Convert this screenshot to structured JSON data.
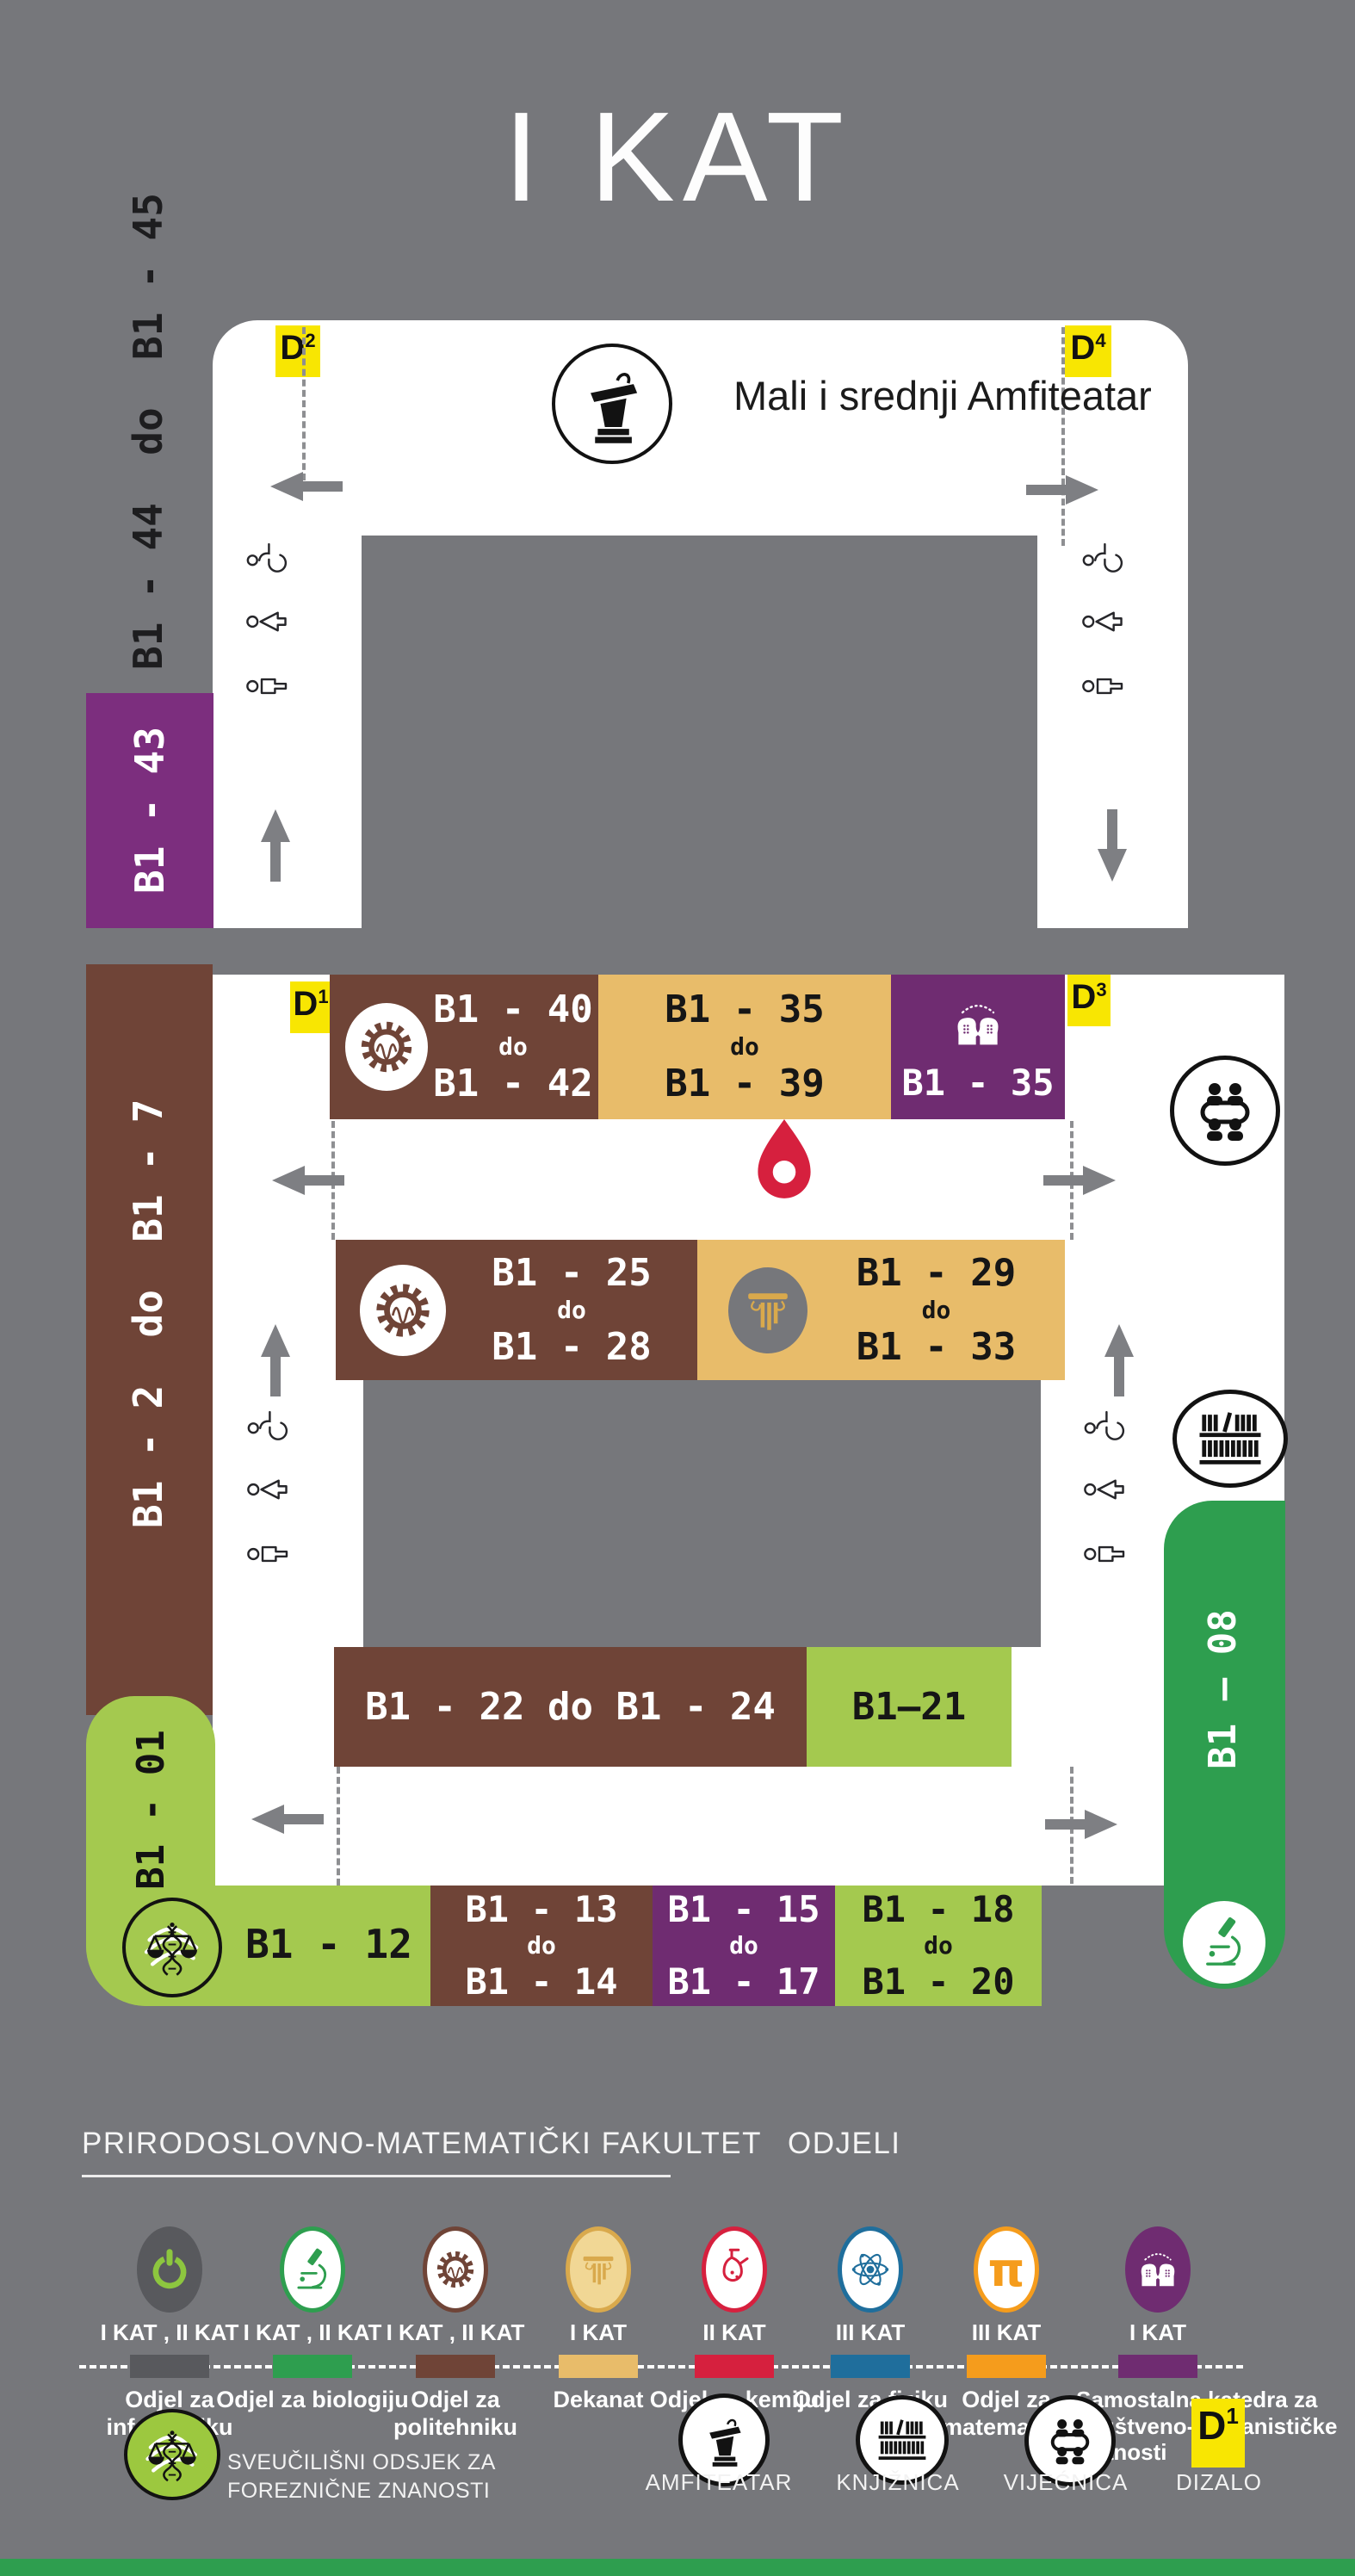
{
  "title": "I KAT",
  "colors": {
    "background": "#76777B",
    "corridor_white": "#FFFFFF",
    "politehnika_brown": "#6F4437",
    "dekanat_tan": "#E8BC6A",
    "katedra_purple": "#6F2C71",
    "wing_purple": "#7C2E7E",
    "forenzika_light_green": "#A4C94F",
    "biologija_green": "#2E9E4F",
    "informatika_gray": "#58595D",
    "kemija_red": "#D6203E",
    "fizika_blue": "#1F6E9C",
    "matematika_orange": "#F59C1C",
    "elevator_yellow": "#F8E602",
    "pin_red": "#D6203E"
  },
  "map": {
    "amphitheater_label": "Mali i srednji Amfiteatar",
    "badges": {
      "d1": {
        "base": "D",
        "sup": "1"
      },
      "d2": {
        "base": "D",
        "sup": "2"
      },
      "d3": {
        "base": "D",
        "sup": "3"
      },
      "d4": {
        "base": "D",
        "sup": "4"
      }
    },
    "wing_labels": {
      "b1_44_45": "B1 - 44  do  B1 - 45",
      "b1_43": "B1 - 43",
      "b1_2_7": "B1 - 2  do  B1 - 7",
      "b1_01": "B1 - 01",
      "b1_08": "B1 — 08"
    },
    "rooms": {
      "r40_42": {
        "top": "B1 - 40",
        "mid": "do",
        "bottom": "B1 - 42"
      },
      "r35_39": {
        "top": "B1 - 35",
        "mid": "do",
        "bottom": "B1 - 39"
      },
      "r35": {
        "label": "B1 - 35"
      },
      "r25_28": {
        "top": "B1 - 25",
        "mid": "do",
        "bottom": "B1 - 28"
      },
      "r29_33": {
        "top": "B1 - 29",
        "mid": "do",
        "bottom": "B1 - 33"
      },
      "r22_24": {
        "label": "B1 - 22  do  B1 - 24"
      },
      "r21": {
        "label": "B1—21"
      },
      "r12": {
        "label": "B1 - 12"
      },
      "r13_14": {
        "top": "B1 - 13",
        "mid": "do",
        "bottom": "B1 - 14"
      },
      "r15_17": {
        "top": "B1 - 15",
        "mid": "do",
        "bottom": "B1 - 17"
      },
      "r18_20": {
        "top": "B1 - 18",
        "mid": "do",
        "bottom": "B1 - 20"
      }
    }
  },
  "legend": {
    "heading": "PRIRODOSLOVNO-MATEMATIČKI FAKULTET",
    "heading_suffix": "ODJELI",
    "pi_symbol": "π",
    "departments": [
      {
        "name": "Odjel za informatiku",
        "floors": "I KAT , II KAT",
        "color": "#58595D"
      },
      {
        "name": "Odjel za biologiju",
        "floors": "I KAT , II KAT",
        "color": "#2E9E4F"
      },
      {
        "name": "Odjel za politehniku",
        "floors": "I KAT , II KAT",
        "color": "#6F4437"
      },
      {
        "name": "Dekanat",
        "floors": "I KAT",
        "color": "#E8BC6A"
      },
      {
        "name": "Odjel za kemiju",
        "floors": "II KAT",
        "color": "#D6203E"
      },
      {
        "name": "Odjel za fiziku",
        "floors": "III KAT",
        "color": "#1F6E9C"
      },
      {
        "name": "Odjel za matematiku",
        "floors": "III KAT",
        "color": "#F59C1C"
      },
      {
        "name": "Samostalna katedra za Društveno-humanističke znanosti",
        "floors": "I KAT",
        "color": "#6F2C71"
      }
    ],
    "forensics": {
      "line1": "SVEUČILIŠNI ODSJEK ZA",
      "line2": "FOREZNIČNE ZNANOSTI"
    },
    "facilities": [
      {
        "label": "AMFITEATAR"
      },
      {
        "label": "KNJIŽNICA"
      },
      {
        "label": "VIJEĆNICA"
      },
      {
        "label": "DIZALO"
      }
    ],
    "dizalo_badge": {
      "base": "D",
      "sup": "1"
    }
  }
}
